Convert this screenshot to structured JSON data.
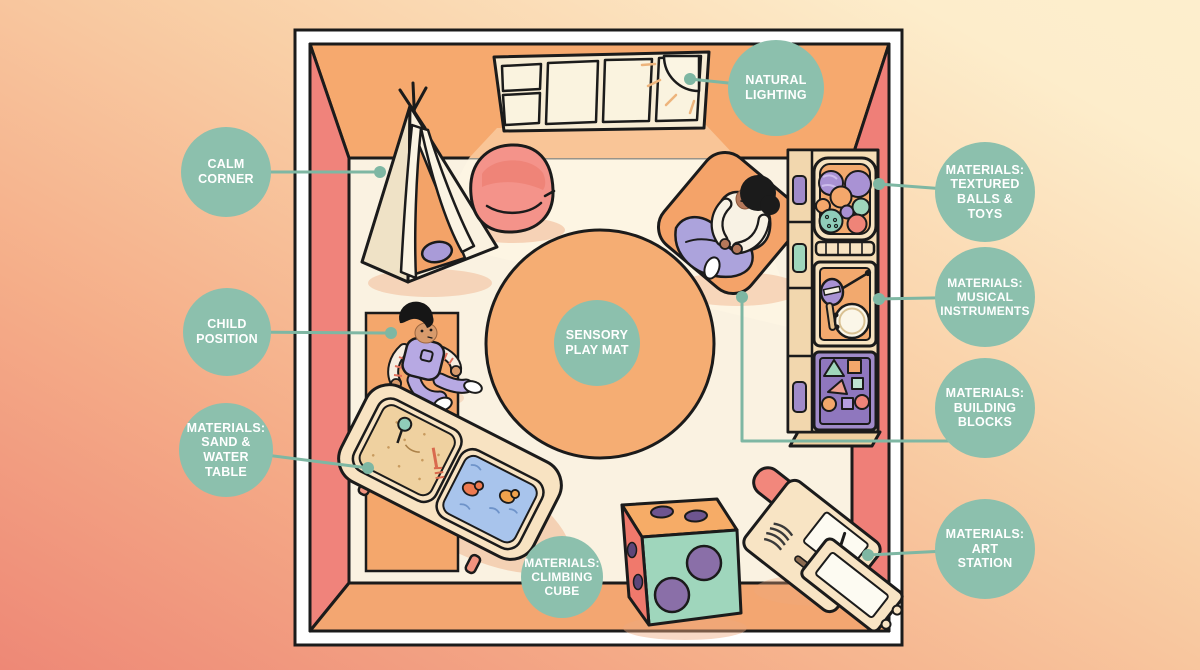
{
  "meta": {
    "title": "Sensory Play Room Layout Infographic"
  },
  "callouts": {
    "natural_lighting": {
      "label": "NATURAL\nLIGHTING"
    },
    "calm_corner": {
      "label": "CALM\nCORNER"
    },
    "child_position": {
      "label": "CHILD\nPOSITION"
    },
    "sand_water_table": {
      "label": "MATERIALS:\nSAND &\nWATER\nTABLE"
    },
    "climbing_cube": {
      "label": "MATERIALS:\nCLIMBING\nCUBE"
    },
    "sensory_play_mat": {
      "label": "SENSORY\nPLAY MAT"
    },
    "textured_balls": {
      "label": "MATERIALS:\nTEXTURED\nBALLS &\nTOYS"
    },
    "musical_instruments": {
      "label": "MATERIALS:\nMUSICAL\nINSTRUMENTS"
    },
    "building_blocks": {
      "label": "MATERIALS:\nBUILDING\nBLOCKS"
    },
    "art_station": {
      "label": "MATERIALS:\nART\nSTATION"
    }
  },
  "colors": {
    "label_bg": "#8CC0AD",
    "label_text": "#FFFFFF",
    "connector": "#7EB7A3",
    "outline": "#1B1B1B",
    "floor": "#FAF2E1",
    "wall_top": "#F6A96E",
    "wall_side": "#F0837B",
    "play_mat": "#F5AD73",
    "frame": "#FFFFFF",
    "background_corners": [
      "#EE8876",
      "#FDEECD"
    ]
  },
  "scene_objects": [
    "window-with-sun",
    "teepee-tent",
    "bean-bag",
    "sensory-play-mat",
    "adult-on-floor-cushion",
    "child-on-rug",
    "sand-and-water-table",
    "climbing-cube-die",
    "toy-shelf-unit",
    "textured-balls-basket",
    "musical-instruments-crate",
    "building-blocks-crate",
    "art-station-desk"
  ]
}
